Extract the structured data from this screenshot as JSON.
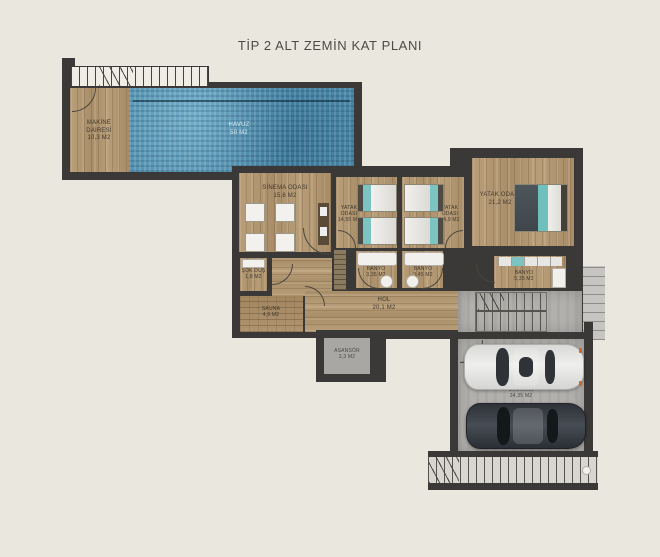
{
  "title": "TİP 2 ALT ZEMİN KAT PLANI",
  "rooms": {
    "makine": {
      "name": "MAKİNE DAİRESİ",
      "area": "10,3 M2"
    },
    "havuz": {
      "name": "HAVUZ",
      "area": "50 M2"
    },
    "sinema": {
      "name": "SİNEMA ODASI",
      "area": "15,6 M2"
    },
    "yatak1": {
      "name": "YATAK ODASI",
      "area": "14,55 M2"
    },
    "yatak2": {
      "name": "YATAK ODASI",
      "area": "14,9 M2"
    },
    "yatak3": {
      "name": "YATAK ODASI",
      "area": "21,2 M2"
    },
    "sokdus": {
      "name": "ŞOK DUŞ",
      "area": "1,8 M2"
    },
    "sauna": {
      "name": "SAUNA",
      "area": "4,9 M2"
    },
    "banyo1": {
      "name": "BANYO",
      "area": "3,35 M2"
    },
    "banyo2": {
      "name": "BANYO",
      "area": "3,45 M2"
    },
    "banyo3": {
      "name": "BANYO",
      "area": "5,35 M2"
    },
    "hol": {
      "name": "HOL",
      "area": "20,1 M2"
    },
    "asansor": {
      "name": "ASANSÖR",
      "area": "3,3 M2"
    },
    "otopark": {
      "name": "OTOPARK",
      "area": "34,35 M2"
    }
  },
  "colors": {
    "background": "#eae7df",
    "wall": "#3a3937",
    "wood": "#b39873",
    "pool_blue": "#4e8cab",
    "concrete": "#b2b0ad",
    "accent_teal": "#7cc4c1"
  }
}
